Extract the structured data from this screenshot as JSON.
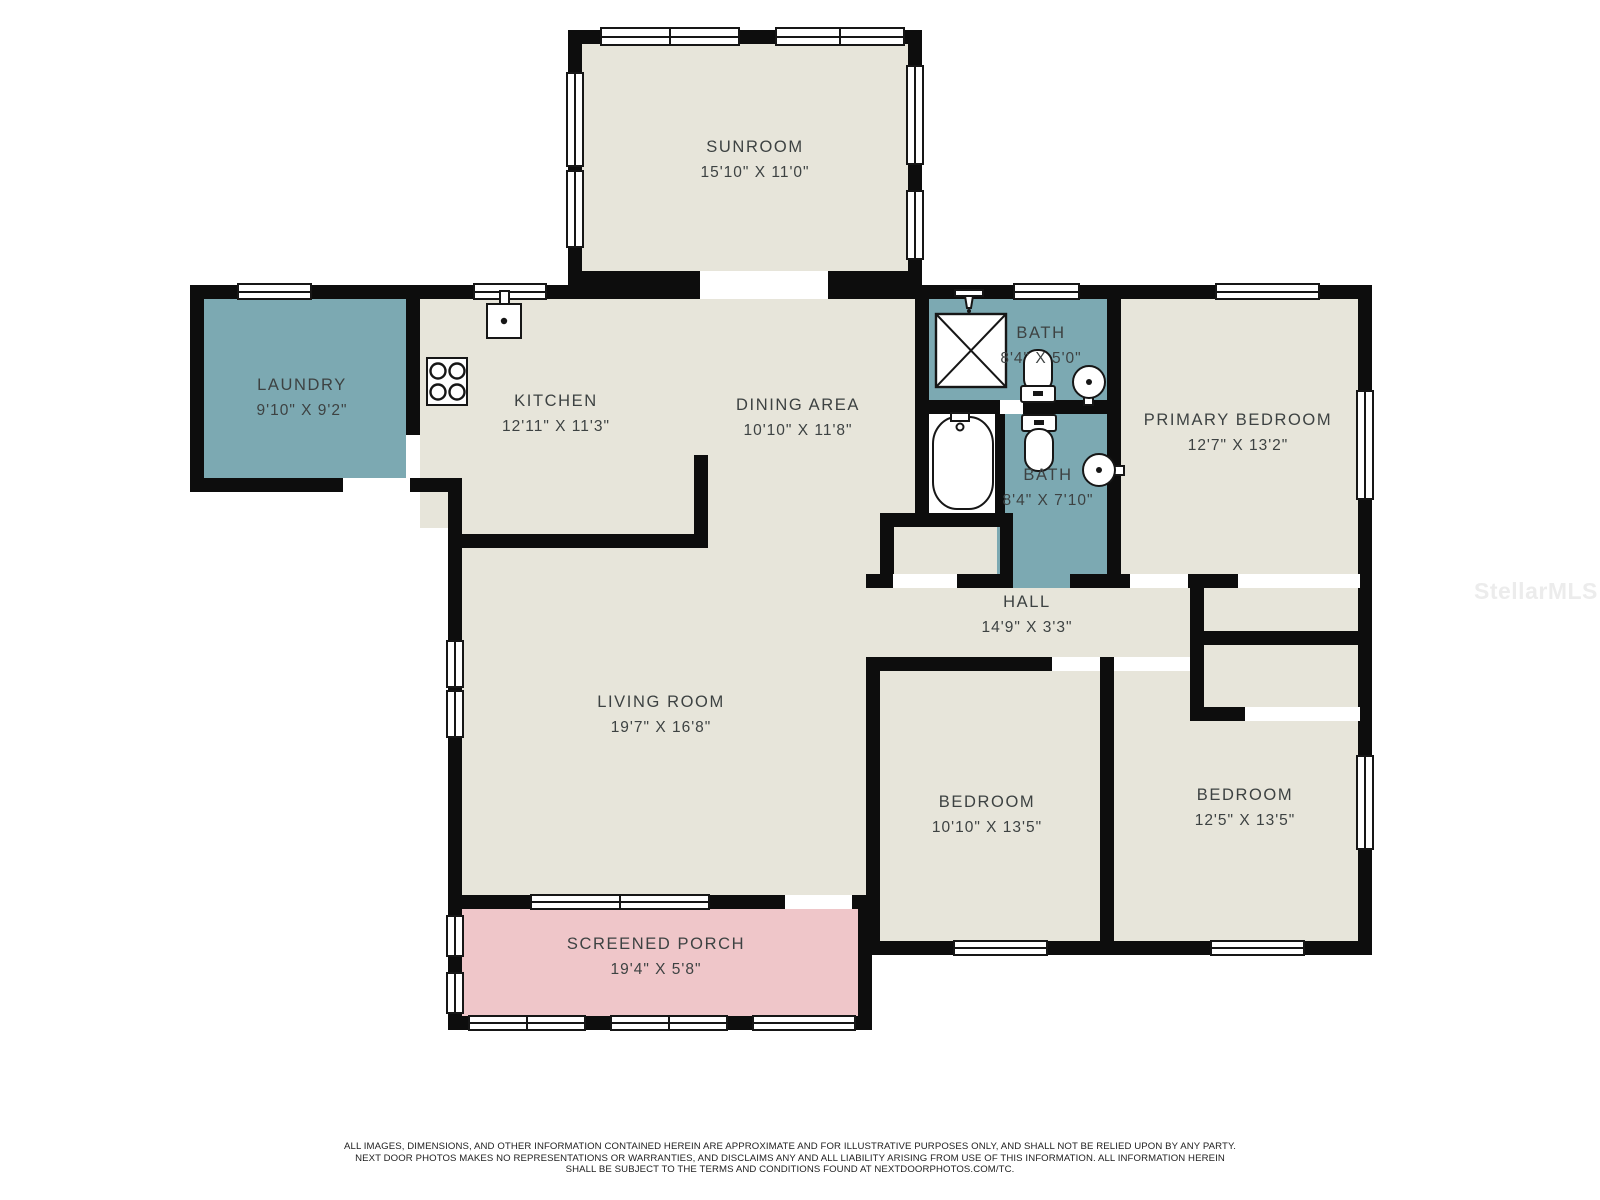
{
  "rooms": [
    {
      "name": "SUNROOM",
      "dims": "15'10\" X 11'0\""
    },
    {
      "name": "LAUNDRY",
      "dims": "9'10\" X 9'2\""
    },
    {
      "name": "KITCHEN",
      "dims": "12'11\" X 11'3\""
    },
    {
      "name": "DINING AREA",
      "dims": "10'10\" X 11'8\""
    },
    {
      "name": "BATH",
      "dims": "8'4\" X 5'0\""
    },
    {
      "name": "BATH",
      "dims": "8'4\" X 7'10\""
    },
    {
      "name": "PRIMARY BEDROOM",
      "dims": "12'7\" X 13'2\""
    },
    {
      "name": "HALL",
      "dims": "14'9\" X 3'3\""
    },
    {
      "name": "LIVING ROOM",
      "dims": "19'7\" X 16'8\""
    },
    {
      "name": "BEDROOM",
      "dims": "10'10\" X 13'5\""
    },
    {
      "name": "BEDROOM",
      "dims": "12'5\" X 13'5\""
    },
    {
      "name": "SCREENED PORCH",
      "dims": "19'4\" X 5'8\""
    }
  ],
  "watermark": "StellarMLS",
  "disclaimer": {
    "line1": "ALL IMAGES, DIMENSIONS, AND OTHER INFORMATION CONTAINED HEREIN ARE APPROXIMATE AND FOR ILLUSTRATIVE PURPOSES ONLY, AND SHALL NOT BE RELIED UPON BY ANY PARTY.",
    "line2": "NEXT DOOR PHOTOS MAKES NO REPRESENTATIONS OR WARRANTIES, AND DISCLAIMS ANY AND ALL LIABILITY ARISING FROM USE OF THIS INFORMATION. ALL INFORMATION HEREIN",
    "line3": "SHALL BE SUBJECT TO THE TERMS AND CONDITIONS FOUND AT NEXTDOORPHOTOS.COM/TC."
  },
  "colors": {
    "room": "#e7e5da",
    "wet_room": "#7ca9b2",
    "porch": "#efc6c9",
    "wall": "#0d0d0d",
    "label_text": "#3d4242",
    "watermark": "#ececec"
  },
  "fixtures": [
    "stove-icon",
    "kitchen-sink-icon",
    "shower-icon",
    "toilet-icon",
    "bathtub-icon",
    "basin-icon",
    "faucet-icon"
  ]
}
